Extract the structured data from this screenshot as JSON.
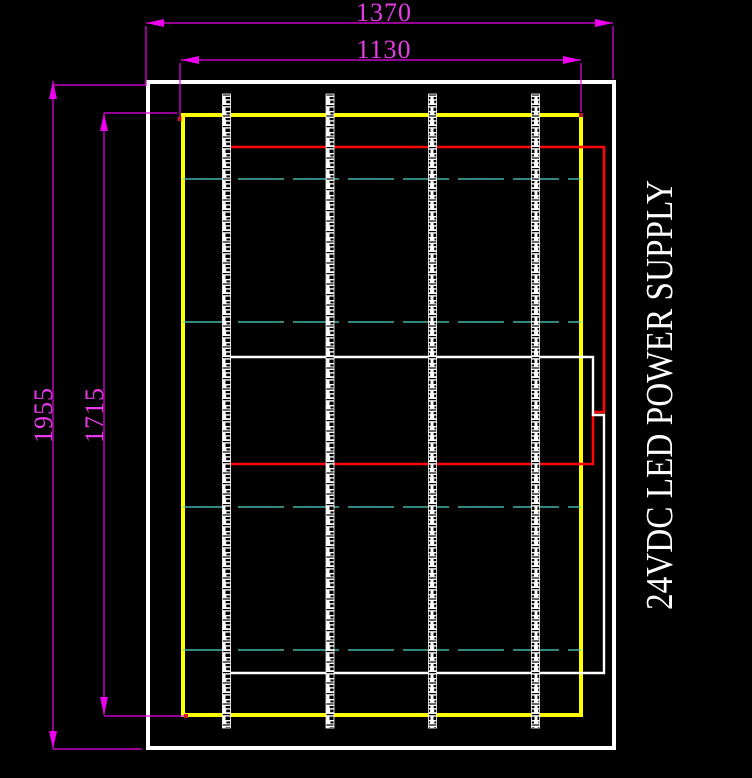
{
  "drawing": {
    "title": "24VDC LED POWER SUPPLY",
    "dimensions": {
      "outer_width": "1370",
      "inner_width": "1130",
      "outer_height": "1955",
      "inner_height": "1715"
    },
    "led_strips": {
      "count": 4
    },
    "crossbars": {
      "count": 4,
      "style": "dashed"
    },
    "colors": {
      "background": "#000000",
      "dimension": "#EE00EE",
      "outer_frame": "#FFFFFF",
      "inner_frame": "#FFFF00",
      "wiring_red": "#FF0606",
      "wiring_white": "#FFFFFF",
      "crossbar_cyan": "#4FD8CC"
    }
  }
}
